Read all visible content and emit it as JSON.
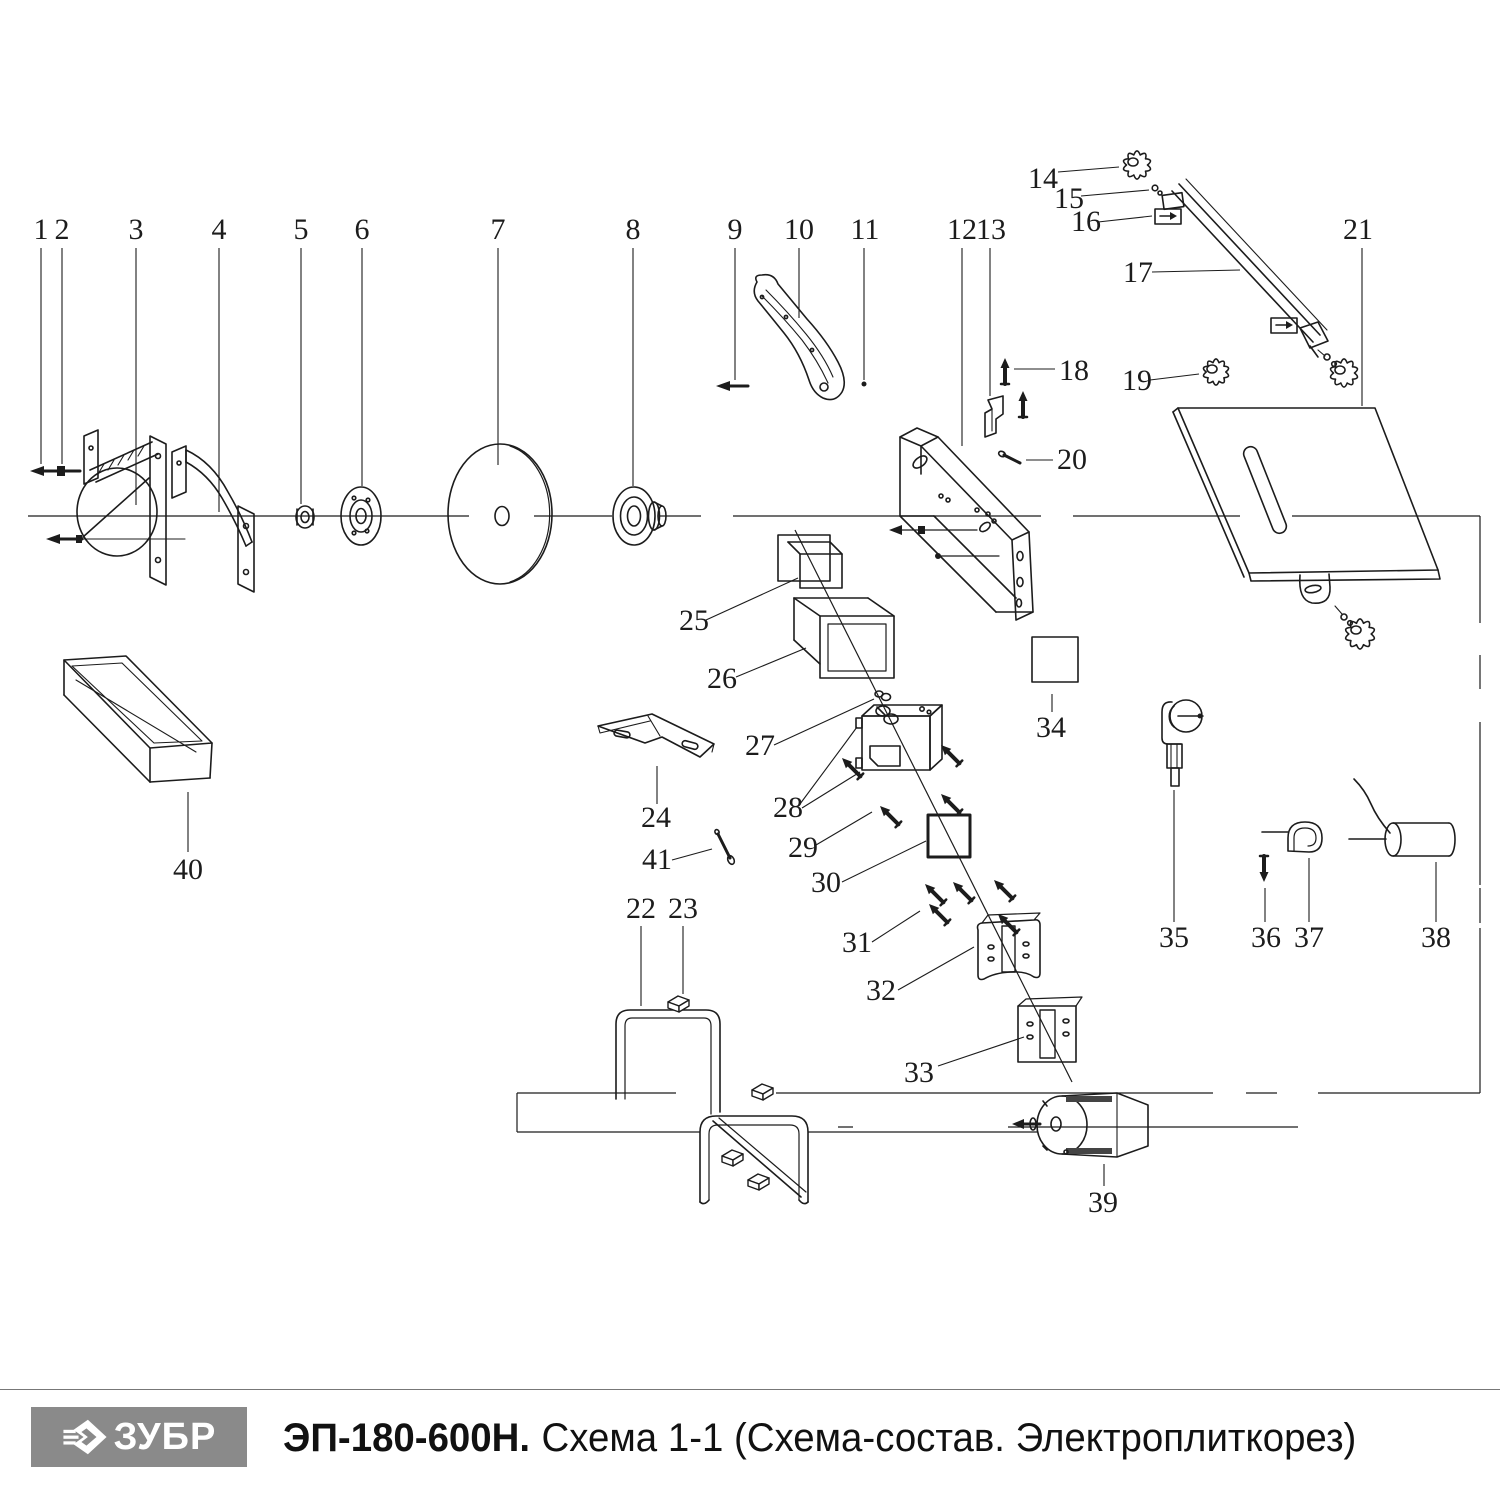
{
  "footer": {
    "brand": "ЗУБР",
    "model": "ЭП-180-600Н.",
    "subtitle": "Схема 1-1 (Схема-состав. Электроплиткорез)"
  },
  "colors": {
    "line": "#1c1c1c",
    "logo_bg": "#8a8a8a",
    "text": "#111111",
    "band": "#444444"
  },
  "callouts": [
    "1",
    "2",
    "3",
    "4",
    "5",
    "6",
    "7",
    "8",
    "9",
    "10",
    "11",
    "12",
    "13",
    "14",
    "15",
    "16",
    "17",
    "18",
    "19",
    "20",
    "21",
    "22",
    "23",
    "24",
    "25",
    "26",
    "27",
    "28",
    "29",
    "30",
    "31",
    "32",
    "33",
    "34",
    "35",
    "36",
    "37",
    "38",
    "39",
    "40",
    "41"
  ]
}
